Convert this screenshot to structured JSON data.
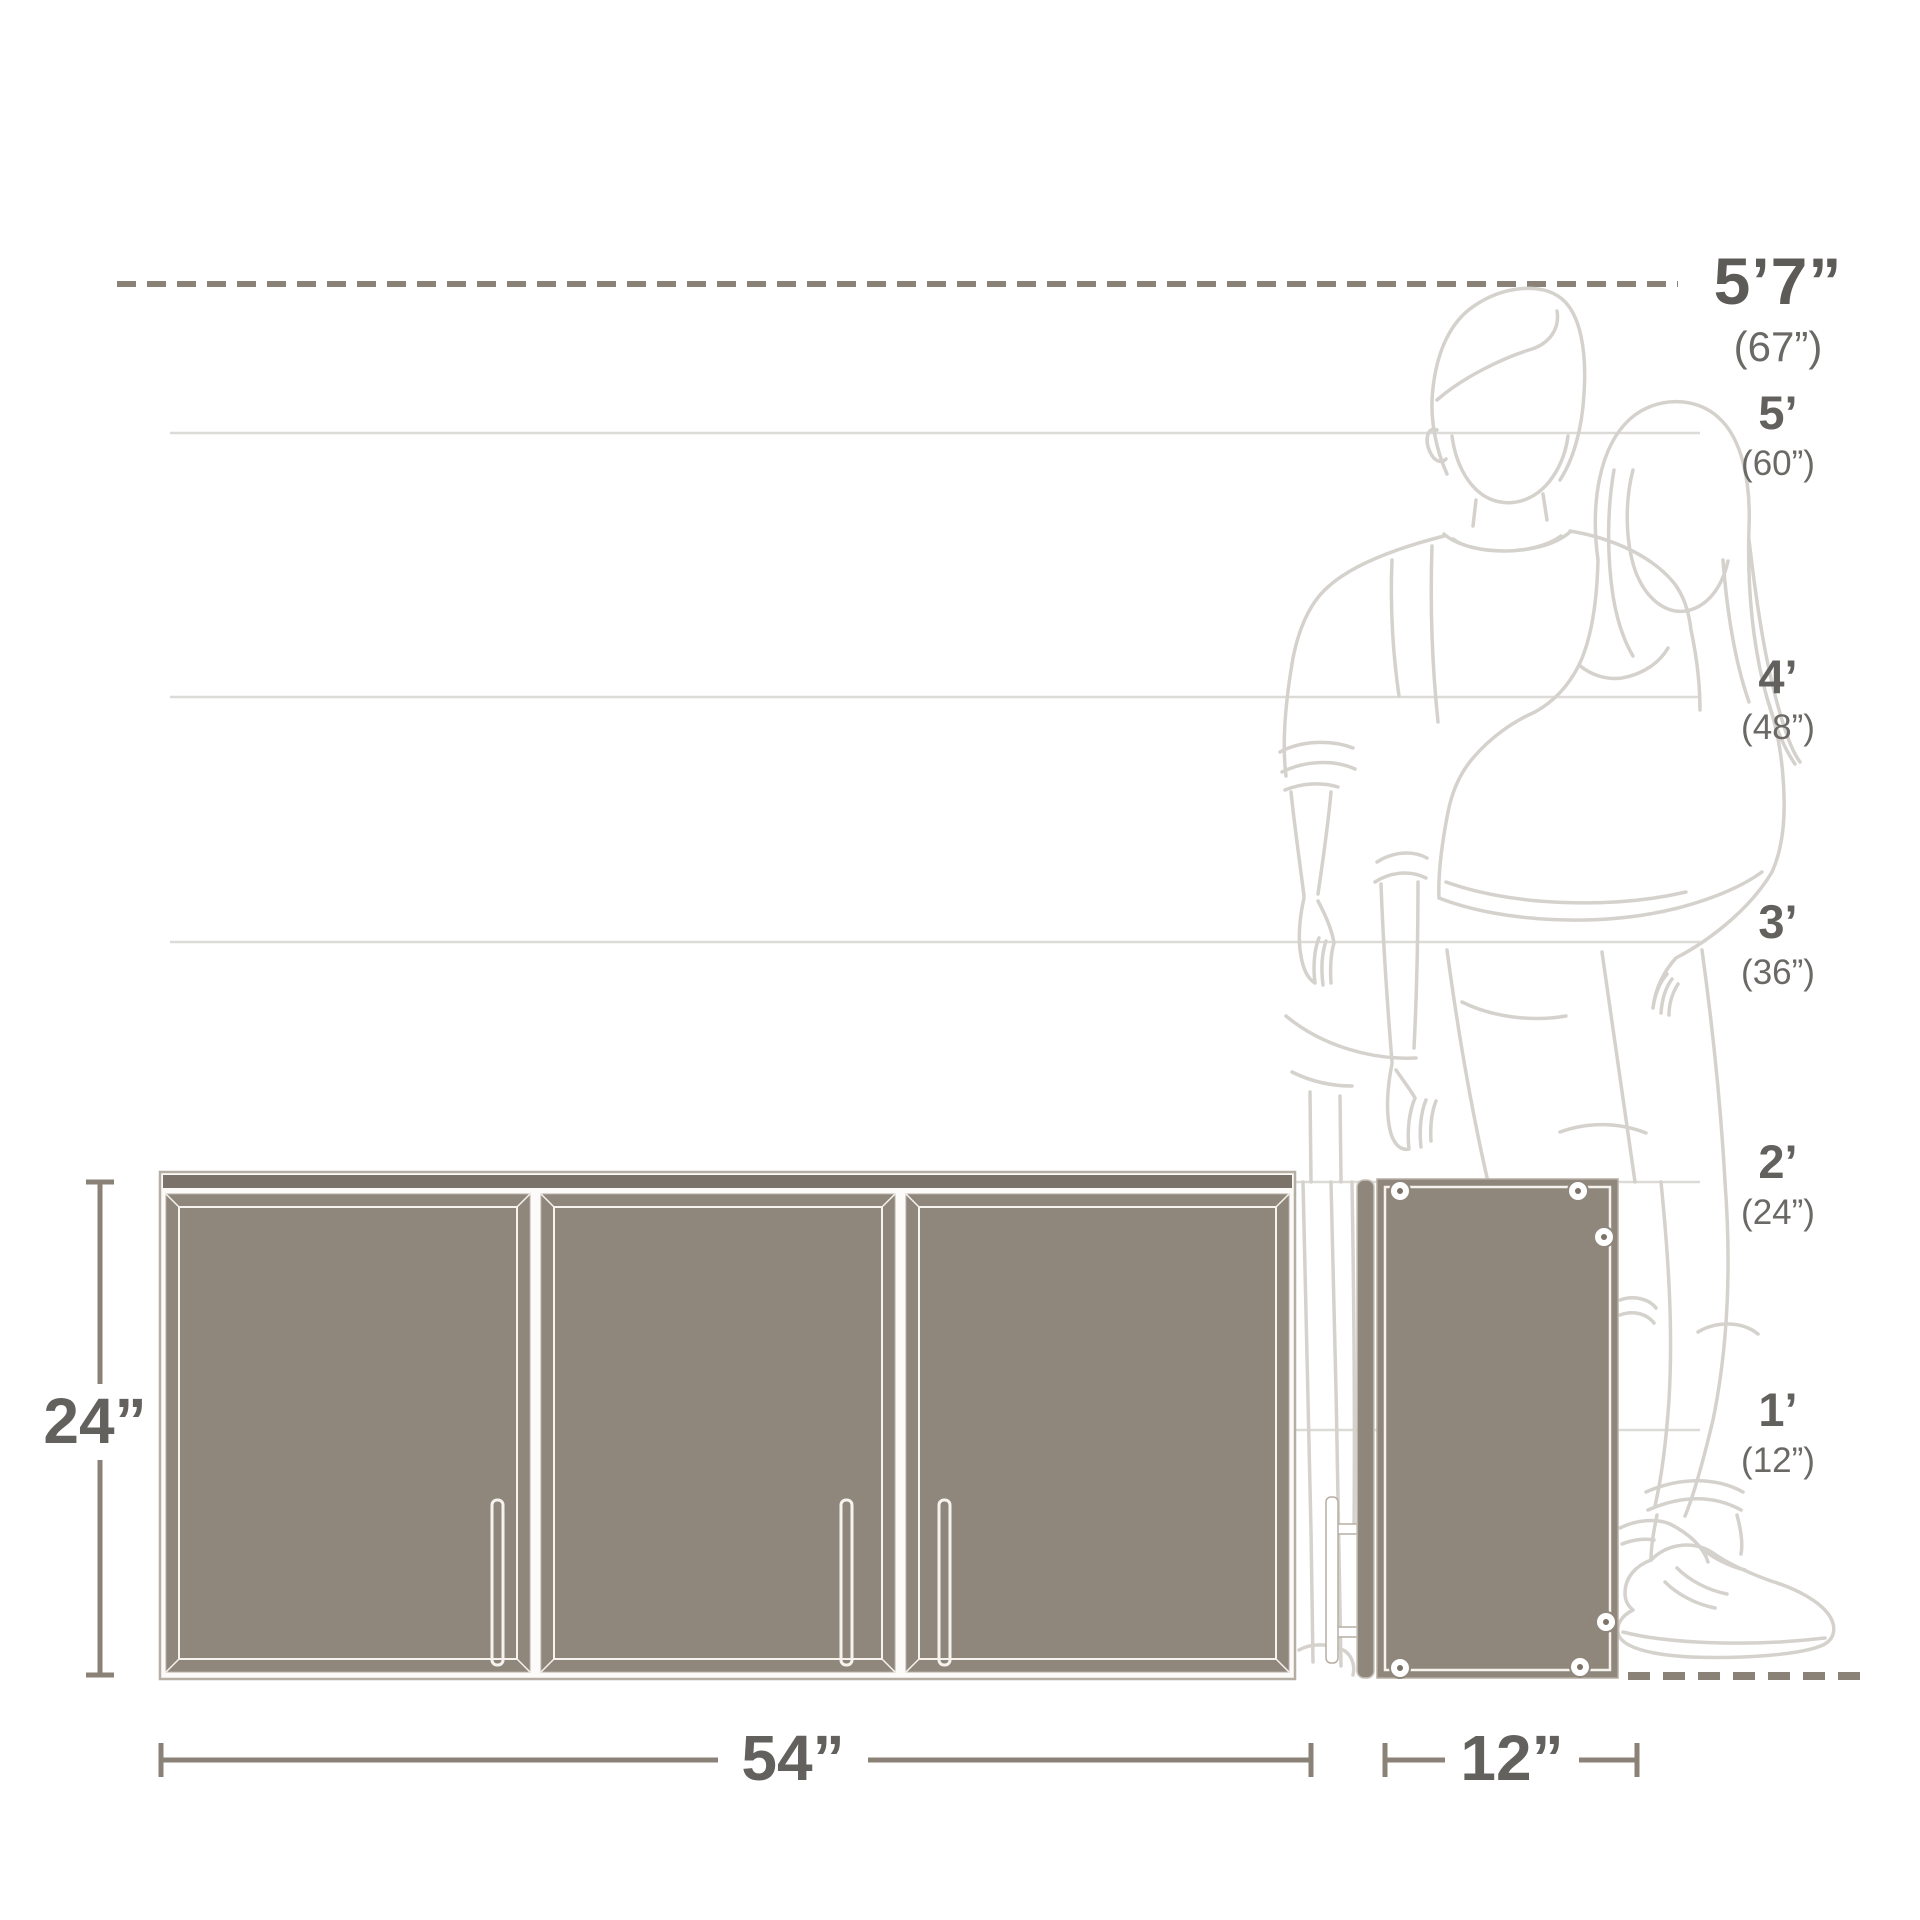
{
  "diagram": {
    "type": "product-dimensions-illustration",
    "subject": "three-door wall cabinet, front view and side view, with human figures for scale"
  },
  "height_marker": {
    "label": "5’7”",
    "sub": "(67”)"
  },
  "scale_marks": [
    {
      "label": "5’",
      "sub": "(60”)"
    },
    {
      "label": "4’",
      "sub": "(48”)"
    },
    {
      "label": "3’",
      "sub": "(36”)"
    },
    {
      "label": "2’",
      "sub": "(24”)"
    },
    {
      "label": "1’",
      "sub": "(12”)"
    }
  ],
  "dimension_labels": {
    "height": "24”",
    "width": "54”",
    "depth": "12”"
  },
  "colors": {
    "panel_taupe": "#8F877C",
    "panel_edge_dark": "#7B7369",
    "cabinet_outline": "#B6AEA3",
    "dimension_line": "#8B8277",
    "gridline": "#DCDBD7",
    "figure_line": "#D5D2CD",
    "text_dark": "#5D5B57",
    "text_sub": "#6B6965",
    "background": "#FFFFFF"
  }
}
